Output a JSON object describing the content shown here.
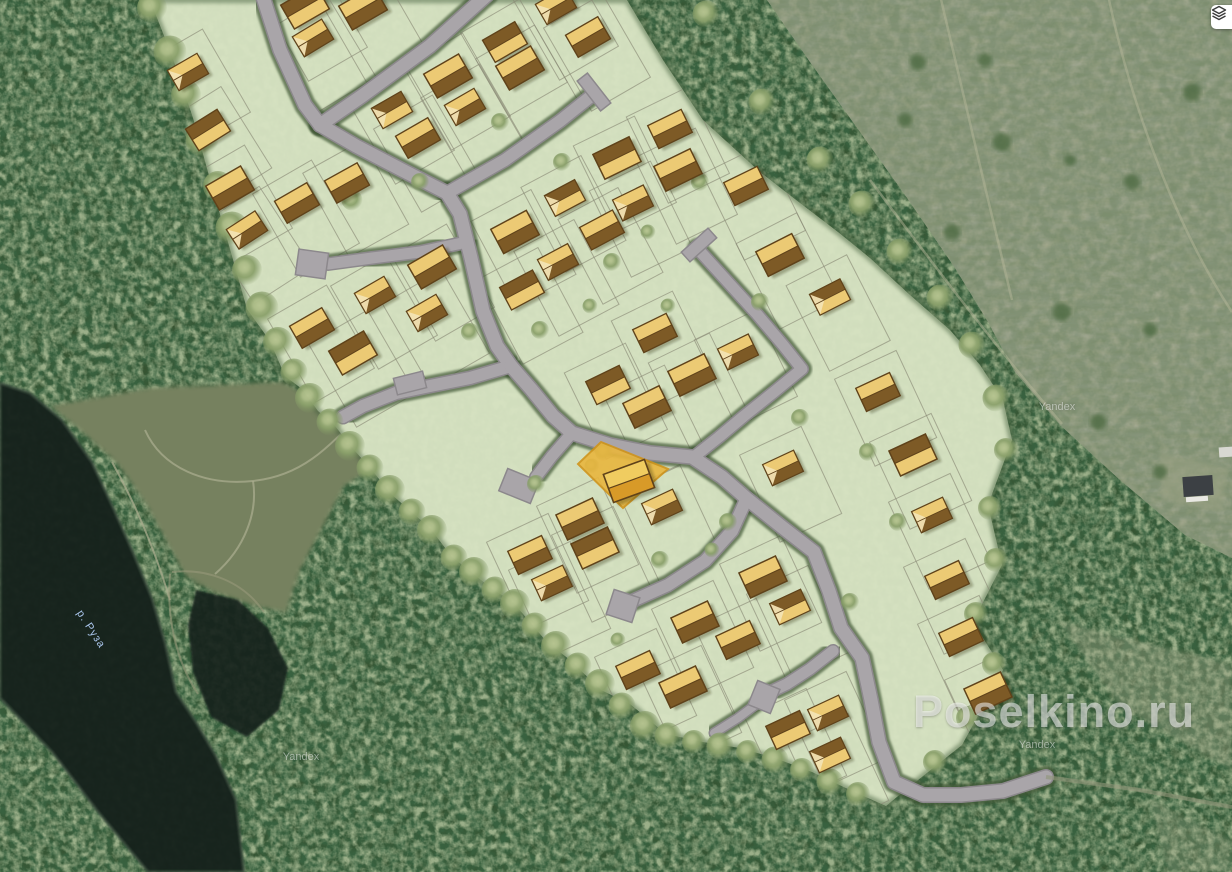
{
  "branding": {
    "watermark": "Poselkino.ru",
    "attribution": "Yandex"
  },
  "map_labels": {
    "river": "р. Руза",
    "river_pos": [
      84,
      608
    ],
    "attribution_positions": [
      [
        1057,
        407
      ],
      [
        301,
        757
      ],
      [
        1037,
        745
      ]
    ],
    "watermark_pos": [
      913,
      686
    ]
  },
  "controls": {
    "layers_button": {
      "icon": "layers-icon",
      "x": 1211,
      "y": 5
    }
  },
  "palette": {
    "forest_base": "#35502e",
    "water": "#16231d",
    "water_edge": "#3d4f41",
    "field": "#9ba284",
    "clearing": "#76815f",
    "trail": "#a9ac8d",
    "settlement": "#d7e3c3",
    "settlement_hedge": "#44603c",
    "plot_line": "#8a8a76",
    "road_fill": "#a9a5a9",
    "road_edge": "#8c888c",
    "hedge": "#3f5636",
    "house_dark": "#7d5a26",
    "house_light": "#ecca74",
    "house_outline": "#5f421a",
    "house_gable": "#f3e3b3",
    "highlight_fill": "#e9b63e",
    "highlight_edge": "#d0941a",
    "highlight_house_dark": "#d89a28",
    "highlight_house_light": "#f0cc60",
    "tree_mid": "#8aa06a",
    "tree_hi": "#b6c490",
    "bush": "#4e6a42"
  },
  "map": {
    "settlement_polygon": "150,0 627,0 663,60 703,120 760,172 800,203 838,232 870,258 910,295 950,330 980,365 1003,400 1012,440 988,505 1002,565 973,622 1003,670 962,745 903,792 886,806 850,790 812,772 775,758 740,748 703,742 666,734 630,704 601,690 570,660 546,641 512,601 492,589 470,571 452,557 430,528 408,509 390,493 372,470 355,451 335,426 318,411 302,389 285,376 270,341 247,309 232,256 213,190 193,118 172,56",
    "field_polygon": "767,0 1232,0 1232,558 1185,535 1120,480 1060,425 1015,372 988,322 955,268 905,195 855,125 810,62",
    "field_tracks": [
      "M 940,-5 C 962,90 988,200 1012,300",
      "M 1108,-5 C 1132,110 1178,230 1232,312",
      "M 870,180 C 930,260 990,340 1062,424"
    ],
    "field_patches": [
      {
        "pts": "1060,622 1232,664 1232,770 1120,706",
        "o": 0.4
      },
      {
        "pts": "1150,800 1232,840 1232,872 1168,872",
        "o": 0.3
      },
      {
        "pts": "1160,452 1228,468 1222,512 1162,500",
        "o": 0.55
      }
    ],
    "clearing_polygon": "50,406 150,388 282,382 318,400 350,430 372,468 344,486 322,528 300,570 286,612 254,606 214,592 186,576 168,544 146,504 118,464 80,430",
    "clearing_trails": [
      "M 145,430 C 162,468 205,486 253,481 C 302,476 328,448 362,412",
      "M 253,481 C 258,512 245,548 215,574",
      "M 112,462 C 140,512 158,560 170,600"
    ],
    "river_polygon": "0,383 30,393 62,420 92,462 112,505 133,552 152,598 165,642 176,692 196,722 216,756 236,800 244,872 148,872 98,812 52,752 0,698",
    "river_arm_polygon": "196,590 238,600 268,628 288,668 279,710 247,737 211,717 193,672 188,625",
    "river_banks": [
      "M 172,572 C 205,568 242,580 264,612",
      "M 170,574 C 166,622 178,664 198,694"
    ],
    "roads": [
      {
        "d": "M 262,-6 L 280,50 L 305,105 L 320,125",
        "w": 13
      },
      {
        "d": "M 320,125 L 362,96 L 430,46 L 488,-6",
        "w": 13
      },
      {
        "d": "M 320,125 L 356,146 L 402,170 L 447,193",
        "w": 13
      },
      {
        "d": "M 447,193 L 505,160 L 560,121 L 590,97",
        "w": 12
      },
      {
        "d": "M 447,193 L 460,214 L 471,258 L 483,311 L 497,346 L 511,366",
        "w": 13
      },
      {
        "d": "M 467,242 L 420,252 L 372,258 L 328,264",
        "w": 11
      },
      {
        "d": "M 511,366 L 470,378 L 430,386 L 396,393 L 363,406 L 343,417",
        "w": 12
      },
      {
        "d": "M 511,366 L 531,389 L 553,416 L 572,433 L 610,445 L 650,453 L 692,457 L 722,477 L 746,498 L 782,527 L 814,552 L 829,591 L 841,628 L 862,658 L 871,700 L 879,742 L 894,782 L 923,795 L 961,795 L 1003,791 L 1046,777",
        "w": 13
      },
      {
        "d": "M 572,433 L 552,456 L 536,477",
        "w": 11
      },
      {
        "d": "M 697,248 L 726,280 L 756,313 L 783,345 L 802,369 L 774,392 L 744,416 L 719,437 L 695,456",
        "w": 11
      },
      {
        "d": "M 746,500 L 732,531 L 705,561 L 668,585 L 628,603",
        "w": 12
      },
      {
        "d": "M 833,651 L 810,669 L 787,684 L 766,694",
        "w": 11
      },
      {
        "d": "M 762,700 L 738,718 L 714,733",
        "w": 8
      }
    ],
    "road_caps": [
      {
        "x": 594,
        "y": 92,
        "w": 38,
        "h": 13,
        "rot": 52
      },
      {
        "x": 312,
        "y": 264,
        "w": 30,
        "h": 26,
        "rot": 8
      },
      {
        "x": 519,
        "y": 486,
        "w": 34,
        "h": 24,
        "rot": 22
      },
      {
        "x": 410,
        "y": 383,
        "w": 30,
        "h": 17,
        "rot": -14
      },
      {
        "x": 699,
        "y": 245,
        "w": 36,
        "h": 13,
        "rot": -42
      },
      {
        "x": 764,
        "y": 697,
        "w": 24,
        "h": 26,
        "rot": 22
      },
      {
        "x": 623,
        "y": 606,
        "w": 27,
        "h": 26,
        "rot": 18
      }
    ],
    "exit_trail": "M 1046,777 L 1140,790 L 1232,807",
    "highlight": {
      "polygon": "578,464 601,442 668,469 623,508",
      "house": {
        "x": 629,
        "y": 481,
        "rot": -20
      }
    },
    "houses": [
      [
        188,
        72,
        -30
      ],
      [
        208,
        130,
        -32
      ],
      [
        230,
        188,
        -30
      ],
      [
        247,
        230,
        -33
      ],
      [
        297,
        203,
        -30
      ],
      [
        305,
        7,
        -30
      ],
      [
        313,
        38,
        -31
      ],
      [
        347,
        183,
        -29
      ],
      [
        363,
        8,
        -30
      ],
      [
        392,
        110,
        -30
      ],
      [
        418,
        138,
        -30
      ],
      [
        448,
        76,
        -30
      ],
      [
        465,
        107,
        -30
      ],
      [
        505,
        42,
        -30
      ],
      [
        520,
        68,
        -30
      ],
      [
        556,
        6,
        -30
      ],
      [
        588,
        37,
        -30
      ],
      [
        617,
        158,
        -26
      ],
      [
        633,
        203,
        -26
      ],
      [
        670,
        129,
        -26
      ],
      [
        678,
        170,
        -26
      ],
      [
        565,
        198,
        -28
      ],
      [
        602,
        230,
        -28
      ],
      [
        515,
        232,
        -28
      ],
      [
        558,
        262,
        -28
      ],
      [
        522,
        290,
        -28
      ],
      [
        432,
        267,
        -30
      ],
      [
        375,
        295,
        -30
      ],
      [
        312,
        328,
        -30
      ],
      [
        353,
        353,
        -30
      ],
      [
        427,
        313,
        -30
      ],
      [
        746,
        186,
        -26
      ],
      [
        780,
        255,
        -27
      ],
      [
        830,
        297,
        -27
      ],
      [
        655,
        333,
        -26
      ],
      [
        692,
        375,
        -26
      ],
      [
        738,
        352,
        -26
      ],
      [
        608,
        385,
        -26
      ],
      [
        647,
        407,
        -26
      ],
      [
        783,
        468,
        -25
      ],
      [
        878,
        392,
        -25
      ],
      [
        913,
        455,
        -25
      ],
      [
        932,
        515,
        -25
      ],
      [
        947,
        580,
        -25
      ],
      [
        763,
        577,
        -25
      ],
      [
        790,
        607,
        -25
      ],
      [
        738,
        640,
        -25
      ],
      [
        695,
        622,
        -25
      ],
      [
        828,
        713,
        -25
      ],
      [
        788,
        730,
        -25
      ],
      [
        580,
        519,
        -25
      ],
      [
        662,
        507,
        -25
      ],
      [
        530,
        555,
        -25
      ],
      [
        595,
        548,
        -25
      ],
      [
        552,
        583,
        -25
      ],
      [
        638,
        670,
        -25
      ],
      [
        683,
        687,
        -25
      ],
      [
        830,
        755,
        -25
      ],
      [
        961,
        637,
        -25
      ],
      [
        988,
        693,
        -25
      ]
    ],
    "trees": [
      [
        152,
        8,
        10
      ],
      [
        170,
        52,
        11
      ],
      [
        186,
        95,
        10
      ],
      [
        202,
        140,
        11
      ],
      [
        218,
        186,
        10
      ],
      [
        232,
        228,
        11
      ],
      [
        247,
        270,
        10
      ],
      [
        262,
        308,
        11
      ],
      [
        278,
        342,
        10
      ],
      [
        294,
        372,
        9
      ],
      [
        310,
        398,
        10
      ],
      [
        330,
        422,
        9
      ],
      [
        350,
        446,
        10
      ],
      [
        370,
        468,
        9
      ],
      [
        390,
        490,
        10
      ],
      [
        412,
        512,
        9
      ],
      [
        432,
        530,
        10
      ],
      [
        454,
        558,
        9
      ],
      [
        474,
        572,
        10
      ],
      [
        495,
        590,
        9
      ],
      [
        515,
        604,
        10
      ],
      [
        535,
        626,
        9
      ],
      [
        556,
        646,
        10
      ],
      [
        578,
        666,
        9
      ],
      [
        600,
        684,
        10
      ],
      [
        622,
        706,
        9
      ],
      [
        645,
        726,
        10
      ],
      [
        668,
        736,
        9
      ],
      [
        694,
        742,
        8
      ],
      [
        720,
        746,
        9
      ],
      [
        748,
        752,
        8
      ],
      [
        775,
        760,
        9
      ],
      [
        802,
        770,
        8
      ],
      [
        830,
        782,
        9
      ],
      [
        858,
        794,
        8
      ],
      [
        706,
        14,
        9
      ],
      [
        762,
        102,
        9
      ],
      [
        820,
        160,
        9
      ],
      [
        862,
        204,
        9
      ],
      [
        900,
        252,
        9
      ],
      [
        940,
        298,
        9
      ],
      [
        972,
        345,
        9
      ],
      [
        996,
        398,
        9
      ],
      [
        1006,
        450,
        8
      ],
      [
        990,
        508,
        8
      ],
      [
        996,
        560,
        8
      ],
      [
        976,
        614,
        8
      ],
      [
        994,
        664,
        8
      ],
      [
        968,
        718,
        8
      ],
      [
        935,
        762,
        8
      ],
      [
        352,
        200,
        7
      ],
      [
        420,
        182,
        6
      ],
      [
        500,
        122,
        6
      ],
      [
        562,
        162,
        6
      ],
      [
        612,
        262,
        6
      ],
      [
        540,
        330,
        6
      ],
      [
        470,
        332,
        6
      ],
      [
        604,
        452,
        6
      ],
      [
        592,
        466,
        5
      ],
      [
        660,
        560,
        6
      ],
      [
        728,
        522,
        6
      ],
      [
        850,
        602,
        6
      ],
      [
        898,
        522,
        6
      ],
      [
        868,
        452,
        6
      ],
      [
        760,
        302,
        6
      ],
      [
        700,
        182,
        6
      ],
      [
        590,
        306,
        5
      ],
      [
        648,
        232,
        5
      ],
      [
        800,
        418,
        6
      ],
      [
        712,
        550,
        5
      ],
      [
        618,
        640,
        5
      ],
      [
        536,
        484,
        6
      ],
      [
        668,
        306,
        5
      ]
    ],
    "bushes": [
      [
        918,
        62,
        8
      ],
      [
        1002,
        142,
        9
      ],
      [
        952,
        232,
        8
      ],
      [
        1062,
        312,
        9
      ],
      [
        1132,
        182,
        8
      ],
      [
        1192,
        92,
        9
      ],
      [
        1098,
        422,
        8
      ],
      [
        1160,
        472,
        7
      ],
      [
        905,
        120,
        7
      ],
      [
        985,
        60,
        7
      ],
      [
        1070,
        160,
        6
      ],
      [
        1150,
        330,
        7
      ]
    ],
    "buildings": [
      {
        "x": 1198,
        "y": 486,
        "w": 30,
        "h": 20,
        "rot": -4,
        "fill": "#3c4044"
      },
      {
        "x": 1197,
        "y": 499,
        "w": 22,
        "h": 5,
        "rot": -4,
        "fill": "#e8e8e2"
      },
      {
        "x": 1226,
        "y": 452,
        "w": 14,
        "h": 10,
        "rot": -4,
        "fill": "#d8d8d2"
      }
    ]
  }
}
